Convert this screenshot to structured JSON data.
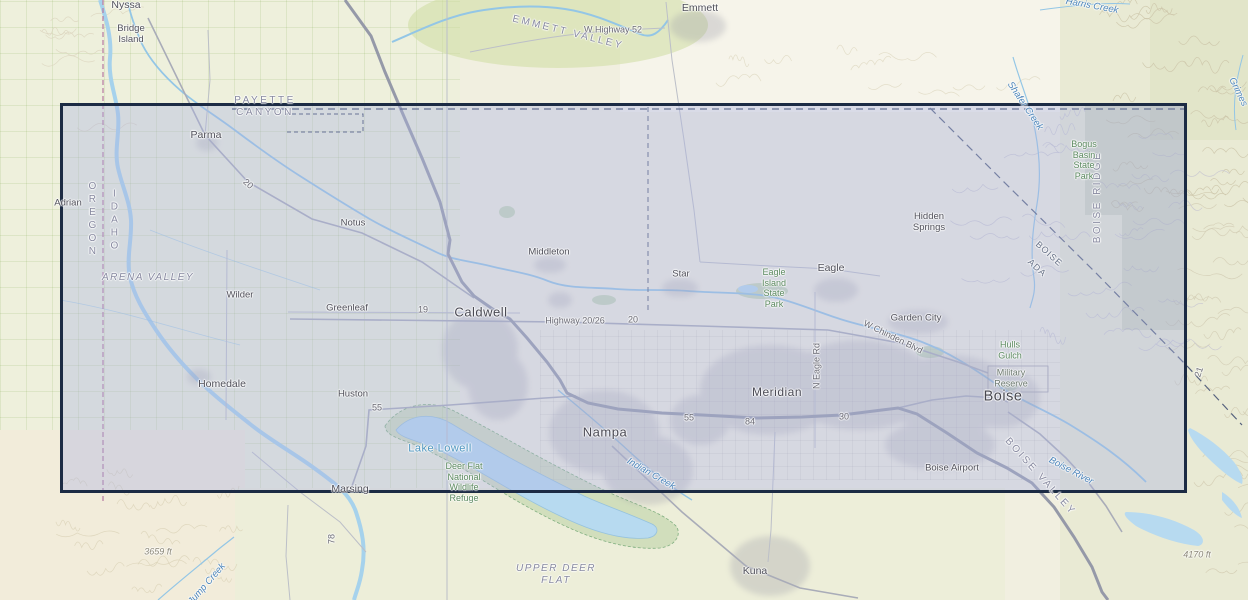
{
  "map": {
    "selection": {
      "x": 60,
      "y": 103,
      "width": 1127,
      "height": 390,
      "fill": "rgba(172,180,226,0.38)",
      "border_color": "#1c2b44"
    },
    "colors": {
      "water": "#93c6e6",
      "water_wide": "#a6d2ec",
      "lake": "#b7daf0",
      "lake_edge": "#95c2de",
      "freeway": "#9599a8",
      "road": "#a9acb8",
      "road_minor": "#bcbfc8",
      "urban": "#9b9ba7",
      "state_line": "#b779a0",
      "county_line": "#3f4c68",
      "refuge_fill": "rgba(168,198,146,0.40)",
      "refuge_edge": "#7fae7f",
      "green_patch": "rgba(150,190,140,0.45)",
      "forest_tint": "rgba(158,170,146,0.28)",
      "town_label": "#50505a",
      "water_label": "#4d86bb",
      "park_label": "#5c8a60",
      "region_label": "#8789a0",
      "road_label": "#6a6a74"
    },
    "labels": [
      {
        "t": "Nyssa",
        "x": 126,
        "y": 5,
        "c": "town"
      },
      {
        "t": "Bridge\nIsland",
        "x": 131,
        "y": 34,
        "c": "town-sm"
      },
      {
        "t": "Emmett",
        "x": 700,
        "y": 8,
        "c": "town"
      },
      {
        "t": "W Highway 52",
        "x": 613,
        "y": 30,
        "c": "road"
      },
      {
        "t": "EMMETT VALLEY",
        "x": 568,
        "y": 33,
        "c": "region",
        "r": 14
      },
      {
        "t": "PAYETTE\nCANYON",
        "x": 265,
        "y": 107,
        "c": "region"
      },
      {
        "t": "Parma",
        "x": 206,
        "y": 135,
        "c": "town"
      },
      {
        "t": "Adrian",
        "x": 68,
        "y": 203,
        "c": "town-sm"
      },
      {
        "t": "OREGON",
        "x": 92,
        "y": 220,
        "c": "vert"
      },
      {
        "t": "IDAHO",
        "x": 114,
        "y": 221,
        "c": "vert"
      },
      {
        "t": "Notus",
        "x": 353,
        "y": 223,
        "c": "town-sm"
      },
      {
        "t": "Middleton",
        "x": 549,
        "y": 252,
        "c": "town-sm"
      },
      {
        "t": "ARENA VALLEY",
        "x": 148,
        "y": 278,
        "c": "region-i"
      },
      {
        "t": "Star",
        "x": 681,
        "y": 274,
        "c": "town-sm"
      },
      {
        "t": "Eagle",
        "x": 831,
        "y": 268,
        "c": "town"
      },
      {
        "t": "Eagle\nIsland\nState\nPark",
        "x": 774,
        "y": 288,
        "c": "park"
      },
      {
        "t": "Wilder",
        "x": 240,
        "y": 295,
        "c": "town-sm"
      },
      {
        "t": "Greenleaf",
        "x": 347,
        "y": 308,
        "c": "town-sm"
      },
      {
        "t": "Caldwell",
        "x": 481,
        "y": 312,
        "c": "town-lg"
      },
      {
        "t": "Highway 20/26",
        "x": 575,
        "y": 321,
        "c": "road"
      },
      {
        "t": "20",
        "x": 633,
        "y": 320,
        "c": "road"
      },
      {
        "t": "19",
        "x": 423,
        "y": 310,
        "c": "road"
      },
      {
        "t": "20",
        "x": 248,
        "y": 184,
        "c": "road",
        "r": 42
      },
      {
        "t": "Hidden\nSprings",
        "x": 929,
        "y": 222,
        "c": "town-sm"
      },
      {
        "t": "Garden City",
        "x": 916,
        "y": 318,
        "c": "town-sm"
      },
      {
        "t": "W Chinden Blvd",
        "x": 893,
        "y": 337,
        "c": "road",
        "r": 26
      },
      {
        "t": "N Eagle Rd",
        "x": 817,
        "y": 366,
        "c": "road",
        "r": -90
      },
      {
        "t": "Homedale",
        "x": 222,
        "y": 384,
        "c": "town"
      },
      {
        "t": "Huston",
        "x": 353,
        "y": 394,
        "c": "town-sm"
      },
      {
        "t": "55",
        "x": 377,
        "y": 408,
        "c": "road"
      },
      {
        "t": "Meridian",
        "x": 777,
        "y": 392,
        "c": "town-md"
      },
      {
        "t": "Boise",
        "x": 1003,
        "y": 397,
        "c": "town-xl"
      },
      {
        "t": "Hulls\nGulch",
        "x": 1010,
        "y": 350,
        "c": "park"
      },
      {
        "t": "Military\nReserve",
        "x": 1011,
        "y": 378,
        "c": "park-gray"
      },
      {
        "t": "Nampa",
        "x": 605,
        "y": 432,
        "c": "town-lg"
      },
      {
        "t": "55",
        "x": 689,
        "y": 418,
        "c": "road"
      },
      {
        "t": "84",
        "x": 750,
        "y": 422,
        "c": "road"
      },
      {
        "t": "30",
        "x": 844,
        "y": 417,
        "c": "road"
      },
      {
        "t": "Lake Lowell",
        "x": 440,
        "y": 449,
        "c": "lake"
      },
      {
        "t": "Deer Flat\nNational\nWildlife\nRefuge",
        "x": 464,
        "y": 482,
        "c": "park"
      },
      {
        "t": "Marsing",
        "x": 350,
        "y": 489,
        "c": "town"
      },
      {
        "t": "Indian Creek",
        "x": 651,
        "y": 474,
        "c": "water",
        "r": 30
      },
      {
        "t": "Boise Airport",
        "x": 952,
        "y": 468,
        "c": "town-sm"
      },
      {
        "t": "BOISE VALLEY",
        "x": 1040,
        "y": 477,
        "c": "region",
        "r": 48
      },
      {
        "t": "Boise River",
        "x": 1071,
        "y": 471,
        "c": "water",
        "r": 28
      },
      {
        "t": "Kuna",
        "x": 755,
        "y": 571,
        "c": "town"
      },
      {
        "t": "UPPER DEER\nFLAT",
        "x": 556,
        "y": 575,
        "c": "region-i"
      },
      {
        "t": "3659 ft",
        "x": 158,
        "y": 552,
        "c": "elev"
      },
      {
        "t": "4170 ft",
        "x": 1197,
        "y": 555,
        "c": "elev"
      },
      {
        "t": "Jump Creek",
        "x": 207,
        "y": 584,
        "c": "water",
        "r": -49
      },
      {
        "t": "78",
        "x": 332,
        "y": 539,
        "c": "road",
        "r": -90
      },
      {
        "t": "BOISE RIDGE",
        "x": 1098,
        "y": 197,
        "c": "region",
        "r": -90
      },
      {
        "t": "Bogus\nBasin\nState\nPark",
        "x": 1084,
        "y": 160,
        "c": "park"
      },
      {
        "t": "Shafer Creek",
        "x": 1025,
        "y": 106,
        "c": "water",
        "r": 56
      },
      {
        "t": "Harris Creek",
        "x": 1092,
        "y": 6,
        "c": "water",
        "r": 10
      },
      {
        "t": "Grimes",
        "x": 1238,
        "y": 92,
        "c": "water",
        "r": 64
      },
      {
        "t": "BOISE",
        "x": 1049,
        "y": 254,
        "c": "county",
        "r": 42
      },
      {
        "t": "ADA",
        "x": 1037,
        "y": 268,
        "c": "county",
        "r": 42
      },
      {
        "t": "21",
        "x": 1199,
        "y": 372,
        "c": "road",
        "r": -72
      }
    ]
  }
}
